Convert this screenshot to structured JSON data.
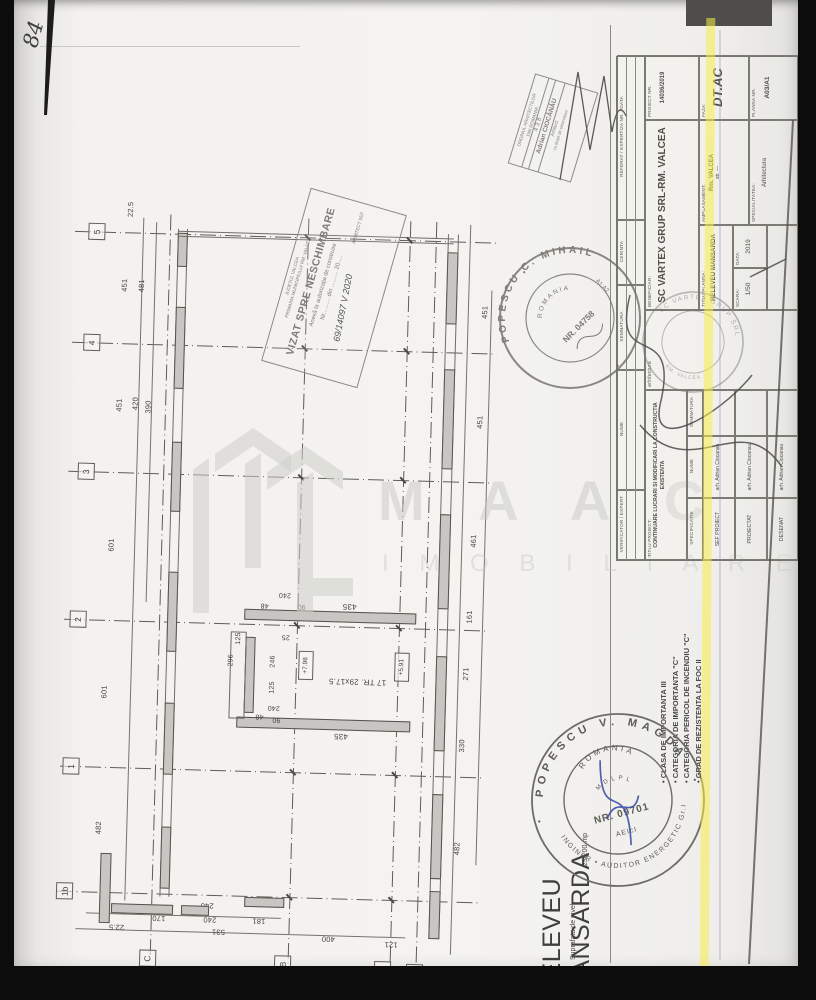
{
  "page": {
    "handwritten_number": "84"
  },
  "watermark": {
    "brand_letters": "M A A C",
    "subtitle_letters": "I M O B I L I A R E"
  },
  "plan": {
    "row_axes": [
      "5",
      "4",
      "3",
      "2",
      "1",
      "1b"
    ],
    "col_axes": [
      "C",
      "B",
      "A",
      "A'"
    ],
    "dims": {
      "top": "22.5",
      "left_outer": [
        "451",
        "451",
        "601",
        "601",
        "482"
      ],
      "left_inner_5_4": "481",
      "left_inner_4_3a": "420",
      "left_inner_4_3b": "390",
      "right": [
        "451",
        "451",
        "461",
        "161",
        "271",
        "330",
        "482"
      ],
      "bottom_outer": [
        "22.5",
        "531",
        "400",
        "121"
      ],
      "bottom_inner": [
        "170",
        "240",
        "240",
        "181"
      ]
    },
    "stair": {
      "treads": "17 TR. 29x17.5",
      "d435_top": "435",
      "d435_bottom": "435",
      "d240_top": "240",
      "d240_bottom": "240",
      "d90_top": "90",
      "d90_bottom": "90",
      "d48_top": "48",
      "d48_bottom": "48",
      "d25": "25",
      "d125_a": "125",
      "d125_b": "125",
      "d296": "296",
      "d246": "246",
      "level_a": "+7.98",
      "level_b": "+5.91"
    }
  },
  "stamps": {
    "oar": {
      "org_line1": "ORDINUL ARHITECTILOR",
      "org_line2": "DIN ROMANIA",
      "number": "438",
      "name": "Adrian CIOCĂNĂU",
      "title": "Arhitect",
      "note": "cu drept de semnatura"
    },
    "vizat": {
      "header_line1": "JUDETUL VALCEA",
      "header_line2": "PRIMARIA MUNICIPIULUI RM. VALCEA",
      "title": "VIZAT SPRE NESCHIMBARE",
      "subtitle": "Anexă la autorizația de construire",
      "number_line": "Nr.......... din .......... 20.....",
      "handwriting": "69/14097  V  2020",
      "footer": "ARHITECT SEF"
    },
    "verificator_round": {
      "name_arc": "POPESCU C. MIHAIL",
      "country": "ROMANIA",
      "register_no": "NR. 04758",
      "cerinte": "A1;A2"
    },
    "firm_round": {
      "arc": "SC VARTEX GRUP SRL",
      "arc2": "RM. VALCEA"
    },
    "auditor_round": {
      "name_arc": "POPESCU V. MAGDA",
      "bottom_arc": "INGINER • AUDITOR ENERGETIC Gr.I",
      "country": "ROMANIA",
      "org": "M D L P L",
      "register_no": "NR. 09701",
      "tag": "AEIcI"
    }
  },
  "titleblock": {
    "verif_strip": {
      "col1": "VERIFICATOR / EXPERT",
      "col2": "NUME",
      "col3": "SEMNATURA",
      "col4": "CERINTA",
      "col5": "REFERAT / EXPERTIZA NR. / DATA"
    },
    "titlu_proiect_label": "TITLU PROIECT:",
    "titlu_proiect": "CONTINUARE LUCRARI SI MODIFICARI LA CONSTRUCTIA EXISTENTA",
    "team": {
      "header": [
        "SPECIFICATIE",
        "NUME",
        "SEMNATURA"
      ],
      "rows": [
        {
          "role": "SEF PROIECT",
          "name": "arh. Adrian Ciocanau"
        },
        {
          "role": "PROIECTAT",
          "name": "arh. Adrian Ciocanau"
        },
        {
          "role": "DESENAT",
          "name": "arh. Adrian Ciocanau"
        }
      ]
    },
    "discipline": "arhitectura",
    "beneficiar_label": "BENEFICIAR:",
    "beneficiar": "SC VARTEX GRUP SRL-RM. VALCEA",
    "amplasament_label": "AMPLASAMENT:",
    "amplasament_value1": "Rm. VALCEA",
    "amplasament_value2": "str. —",
    "specialitate_label": "SPECIALITATEA:",
    "specialitate": "Arhitectura",
    "titlu_plansa_label": "TITLU PLANSA:",
    "titlu_plansa": "RELEVEU MANSARDA",
    "scara_label": "SCARA:",
    "scara": "1/50",
    "data_label": "DATA:",
    "data": "2019",
    "proiect_nr_label": "PROIECT NR.",
    "proiect_nr": "14036/2019",
    "faza_label": "FAZA:",
    "faza": "DT.AC",
    "plansa_nr_label": "PLANSA NR.",
    "plansa_nr": "A03/A1"
  },
  "footer": {
    "plan_title": "RELEVEU MANSARDA",
    "area_label": "Suprafata de nivel",
    "area_value": "296.00 mp",
    "notes": [
      "CLASA DE IMPORTANTA III",
      "CATEGORIA DE IMPORTANTA \"C\"",
      "CATEGORIA PERICOL DE INCENDIU \"C\"",
      "GRAD DE REZISTENTA LA FOC II"
    ]
  }
}
